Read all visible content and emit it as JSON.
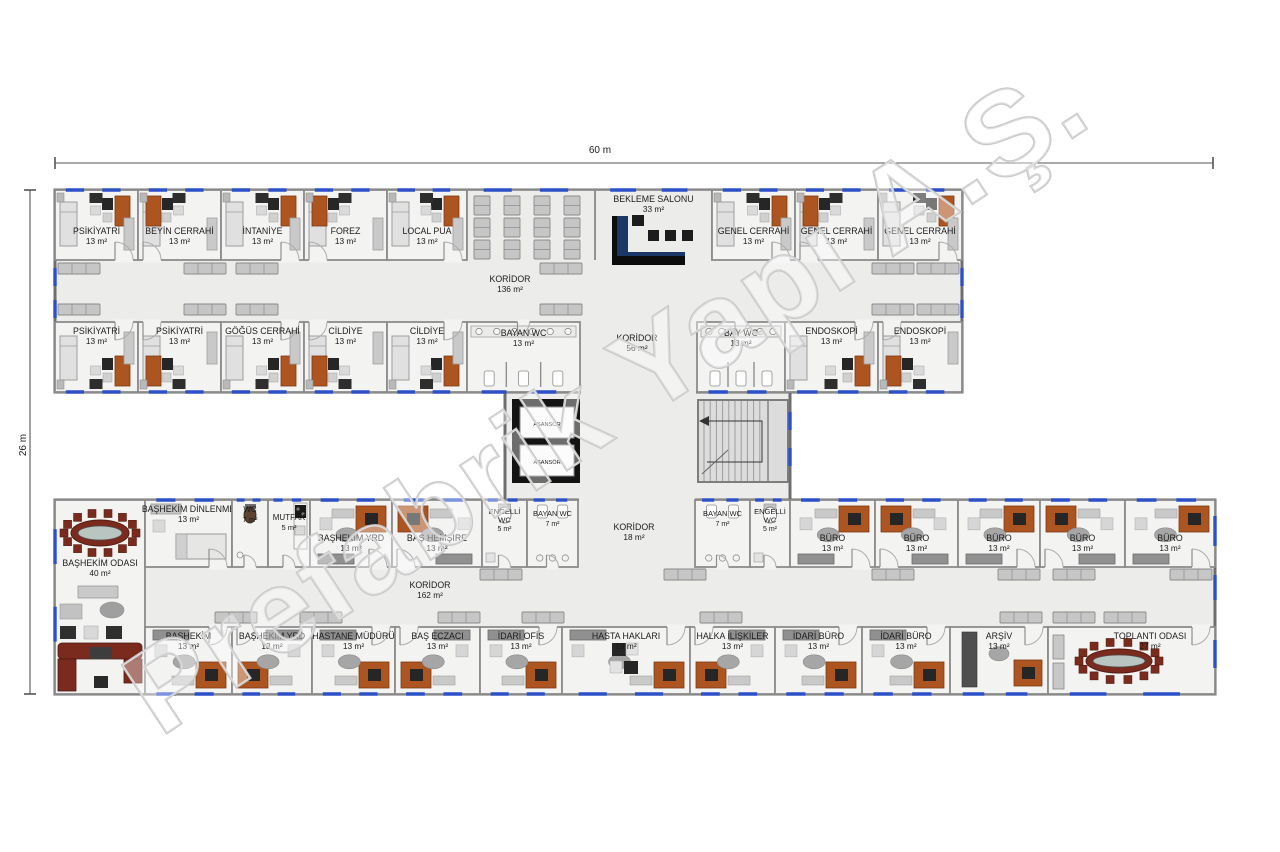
{
  "watermark": "Prefabrik Yapı A.Ş.",
  "dimensions": {
    "width": "60 m",
    "height": "26 m"
  },
  "connector": {
    "elevator_label": "ASANSÖR"
  },
  "colors": {
    "wall": "#6e6e6e",
    "innerWall": "#8c8c8c",
    "room": "#f3f3f2",
    "cor": "#ececeb",
    "win": "#2b50c8",
    "orange": "#ad5520",
    "dark": "#262626",
    "navy": "#1b3768",
    "red": "#7a2b1d",
    "tabletop": "#b9c5c0",
    "bench": "#c6c6c6",
    "benchEdge": "#8a8a8a",
    "label": "#1b1b1b",
    "dim": "#555555",
    "wmStroke": "#c9c9c9"
  },
  "corridors": [
    {
      "n": "KORİDOR",
      "a": "136 m²",
      "x": 510,
      "y": 282
    },
    {
      "n": "KORİDOR",
      "a": "56 m²",
      "x": 637,
      "y": 341
    },
    {
      "n": "KORİDOR",
      "a": "18 m²",
      "x": 634,
      "y": 530
    },
    {
      "n": "KORİDOR",
      "a": "162 m²",
      "x": 430,
      "y": 588
    }
  ],
  "rooms": [
    {
      "n": "PSİKİYATRİ",
      "a": "13 m²",
      "x": 55,
      "y": 190,
      "w": 83,
      "h": 70,
      "k": "ward",
      "d": "b",
      "lp": "b",
      "win": "t"
    },
    {
      "n": "BEYİN CERRAHİ",
      "a": "13 m²",
      "x": 138,
      "y": 190,
      "w": 83,
      "h": 70,
      "k": "ward",
      "d": "b",
      "lp": "b",
      "win": "t",
      "mx": 1
    },
    {
      "n": "İNTANİYE",
      "a": "13 m²",
      "x": 221,
      "y": 190,
      "w": 83,
      "h": 70,
      "k": "ward",
      "d": "b",
      "lp": "b",
      "win": "t"
    },
    {
      "n": "FOREZ",
      "a": "13 m²",
      "x": 304,
      "y": 190,
      "w": 83,
      "h": 70,
      "k": "ward",
      "d": "b",
      "lp": "b",
      "win": "t",
      "mx": 1
    },
    {
      "n": "LOCAL PUA",
      "a": "13 m²",
      "x": 387,
      "y": 190,
      "w": 80,
      "h": 70,
      "k": "ward",
      "d": "b",
      "lp": "b",
      "win": "t"
    },
    {
      "n": "BEKLEME SALONU",
      "a": "33 m²",
      "x": 595,
      "y": 190,
      "w": 117,
      "h": 70,
      "k": "waiting",
      "d": "",
      "lp": "t",
      "win": "t",
      "open": "b"
    },
    {
      "n": "GENEL CERRAHİ",
      "a": "13 m²",
      "x": 712,
      "y": 190,
      "w": 83,
      "h": 70,
      "k": "ward",
      "d": "b",
      "lp": "b",
      "win": "t"
    },
    {
      "n": "GENEL CERRAHİ",
      "a": "13 m²",
      "x": 795,
      "y": 190,
      "w": 83,
      "h": 70,
      "k": "ward",
      "d": "b",
      "lp": "b",
      "win": "t",
      "mx": 1
    },
    {
      "n": "GENEL CERRAHİ",
      "a": "13 m²",
      "x": 878,
      "y": 190,
      "w": 84,
      "h": 70,
      "k": "ward",
      "d": "b",
      "lp": "b",
      "win": "t"
    },
    {
      "n": "PSİKİYATRİ",
      "a": "13 m²",
      "x": 55,
      "y": 322,
      "w": 83,
      "h": 70,
      "k": "ward",
      "d": "t",
      "lp": "t",
      "win": "b"
    },
    {
      "n": "PSİKİYATRİ",
      "a": "13 m²",
      "x": 138,
      "y": 322,
      "w": 83,
      "h": 70,
      "k": "ward",
      "d": "t",
      "lp": "t",
      "win": "b",
      "mx": 1
    },
    {
      "n": "GÖĞÜS CERRAHİ",
      "a": "13 m²",
      "x": 221,
      "y": 322,
      "w": 83,
      "h": 70,
      "k": "ward",
      "d": "t",
      "lp": "t",
      "win": "b"
    },
    {
      "n": "CİLDİYE",
      "a": "13 m²",
      "x": 304,
      "y": 322,
      "w": 83,
      "h": 70,
      "k": "ward",
      "d": "t",
      "lp": "t",
      "win": "b",
      "mx": 1
    },
    {
      "n": "CİLDİYE",
      "a": "13 m²",
      "x": 387,
      "y": 322,
      "w": 80,
      "h": 70,
      "k": "ward",
      "d": "t",
      "lp": "t",
      "win": "b"
    },
    {
      "n": "BAYAN WC",
      "a": "13 m²",
      "x": 467,
      "y": 322,
      "w": 113,
      "h": 70,
      "k": "wc13",
      "d": "t",
      "lp": "t",
      "win": "b",
      "ldy": 14
    },
    {
      "n": "BAY WC",
      "a": "13 m²",
      "x": 697,
      "y": 322,
      "w": 88,
      "h": 70,
      "k": "wc13",
      "d": "t",
      "lp": "t",
      "win": "b",
      "ldy": 14
    },
    {
      "n": "ENDOSKOPİ",
      "a": "13 m²",
      "x": 785,
      "y": 322,
      "w": 93,
      "h": 70,
      "k": "ward",
      "d": "t",
      "lp": "t",
      "win": "b"
    },
    {
      "n": "ENDOSKOPİ",
      "a": "13 m²",
      "x": 878,
      "y": 322,
      "w": 84,
      "h": 70,
      "k": "ward",
      "d": "t",
      "lp": "t",
      "win": "b",
      "mx": 1
    },
    {
      "n": "BAŞHEKİM ODASI",
      "a": "40 m²",
      "x": 55,
      "y": 500,
      "w": 90,
      "h": 194,
      "k": "exec",
      "d": "",
      "lp": "t",
      "win": "l",
      "ldy": 66
    },
    {
      "n": "BAŞHEKİM DİNLENME",
      "a": "13 m²",
      "x": 145,
      "y": 500,
      "w": 87,
      "h": 67,
      "k": "rest",
      "d": "b",
      "lp": "t",
      "win": "t"
    },
    {
      "n": "WC",
      "a": "7 m²",
      "x": 232,
      "y": 500,
      "w": 36,
      "h": 67,
      "k": "wctiny",
      "d": "b",
      "lp": "t",
      "win": "t",
      "fs": 8
    },
    {
      "n": "MUTFAK",
      "a": "5 m²",
      "x": 268,
      "y": 500,
      "w": 42,
      "h": 67,
      "k": "kitchen",
      "d": "b",
      "lp": "t",
      "win": "t",
      "ldy": 20,
      "fs": 8
    },
    {
      "n": "BAŞHEKİM YRD",
      "a": "13 m²",
      "x": 310,
      "y": 500,
      "w": 82,
      "h": 67,
      "k": "office",
      "d": "b",
      "lp": "b",
      "win": "t"
    },
    {
      "n": "BAŞ HEMŞİRE",
      "a": "13 m²",
      "x": 392,
      "y": 500,
      "w": 90,
      "h": 67,
      "k": "office",
      "d": "b",
      "lp": "b",
      "win": "t",
      "mx": 1
    },
    {
      "n": "ENGELLİ WC",
      "a": "5 m²",
      "x": 482,
      "y": 500,
      "w": 45,
      "h": 67,
      "k": "wce",
      "d": "b",
      "lp": "t",
      "win": "t",
      "ldy": 14,
      "fs": 7.5,
      "nl": [
        "ENGELLİ",
        "WC"
      ]
    },
    {
      "n": "BAYAN WC",
      "a": "7 m²",
      "x": 527,
      "y": 500,
      "w": 51,
      "h": 67,
      "k": "wcs",
      "d": "b",
      "lp": "t",
      "win": "t",
      "ldy": 16,
      "fs": 7.5
    },
    {
      "n": "BAYAN WC",
      "a": "7 m²",
      "x": 695,
      "y": 500,
      "w": 55,
      "h": 67,
      "k": "wcs",
      "d": "b",
      "lp": "t",
      "win": "t",
      "ldy": 16,
      "fs": 7.5
    },
    {
      "n": "ENGELLİ WC",
      "a": "5 m²",
      "x": 750,
      "y": 500,
      "w": 40,
      "h": 67,
      "k": "wce",
      "d": "b",
      "lp": "t",
      "win": "t",
      "ldy": 14,
      "fs": 7.5,
      "nl": [
        "ENGELLİ",
        "WC"
      ]
    },
    {
      "n": "BÜRO",
      "a": "13 m²",
      "x": 790,
      "y": 500,
      "w": 85,
      "h": 67,
      "k": "office",
      "d": "b",
      "lp": "b",
      "win": "t"
    },
    {
      "n": "BÜRO",
      "a": "13 m²",
      "x": 875,
      "y": 500,
      "w": 83,
      "h": 67,
      "k": "office",
      "d": "b",
      "lp": "b",
      "win": "t",
      "mx": 1
    },
    {
      "n": "BÜRO",
      "a": "13 m²",
      "x": 958,
      "y": 500,
      "w": 82,
      "h": 67,
      "k": "office",
      "d": "b",
      "lp": "b",
      "win": "t"
    },
    {
      "n": "BÜRO",
      "a": "13 m²",
      "x": 1040,
      "y": 500,
      "w": 85,
      "h": 67,
      "k": "office",
      "d": "b",
      "lp": "b",
      "win": "t",
      "mx": 1
    },
    {
      "n": "BÜRO",
      "a": "13 m²",
      "x": 1125,
      "y": 500,
      "w": 90,
      "h": 67,
      "k": "office",
      "d": "b",
      "lp": "b",
      "win": "t"
    },
    {
      "n": "BAŞHEKİM",
      "a": "13 m²",
      "x": 145,
      "y": 627,
      "w": 87,
      "h": 67,
      "k": "office",
      "d": "t",
      "lp": "t",
      "win": "b"
    },
    {
      "n": "BAŞHEKİM YRD",
      "a": "13 m²",
      "x": 232,
      "y": 627,
      "w": 80,
      "h": 67,
      "k": "office",
      "d": "t",
      "lp": "t",
      "win": "b",
      "mx": 1
    },
    {
      "n": "HASTANE MÜDÜRÜ",
      "a": "13 m²",
      "x": 312,
      "y": 627,
      "w": 83,
      "h": 67,
      "k": "office",
      "d": "t",
      "lp": "t",
      "win": "b"
    },
    {
      "n": "BAŞ ECZACI",
      "a": "13 m²",
      "x": 395,
      "y": 627,
      "w": 85,
      "h": 67,
      "k": "office",
      "d": "t",
      "lp": "t",
      "win": "b",
      "mx": 1
    },
    {
      "n": "İDARİ OFİS",
      "a": "13 m²",
      "x": 480,
      "y": 627,
      "w": 82,
      "h": 67,
      "k": "office",
      "d": "t",
      "lp": "t",
      "win": "b"
    },
    {
      "n": "HASTA HAKLARI",
      "a": "19 m²",
      "x": 562,
      "y": 627,
      "w": 128,
      "h": 67,
      "k": "office2",
      "d": "t",
      "lp": "t",
      "win": "b"
    },
    {
      "n": "HALKA İLİŞKİLER",
      "a": "13 m²",
      "x": 690,
      "y": 627,
      "w": 85,
      "h": 67,
      "k": "office",
      "d": "t",
      "lp": "t",
      "win": "b",
      "mx": 1
    },
    {
      "n": "İDARİ BÜRO",
      "a": "13 m²",
      "x": 775,
      "y": 627,
      "w": 87,
      "h": 67,
      "k": "office",
      "d": "t",
      "lp": "t",
      "win": "b"
    },
    {
      "n": "İDARİ BÜRO",
      "a": "13 m²",
      "x": 862,
      "y": 627,
      "w": 88,
      "h": 67,
      "k": "office",
      "d": "t",
      "lp": "t",
      "win": "b"
    },
    {
      "n": "ARŞİV",
      "a": "13 m²",
      "x": 950,
      "y": 627,
      "w": 98,
      "h": 67,
      "k": "archive",
      "d": "t",
      "lp": "t",
      "win": "b"
    },
    {
      "n": "TOPLANTI ODASI",
      "a": "27 m²",
      "x": 1048,
      "y": 627,
      "w": 167,
      "h": 67,
      "k": "meeting",
      "d": "t",
      "lp": "t",
      "win": "b",
      "lcx": 1150
    }
  ]
}
